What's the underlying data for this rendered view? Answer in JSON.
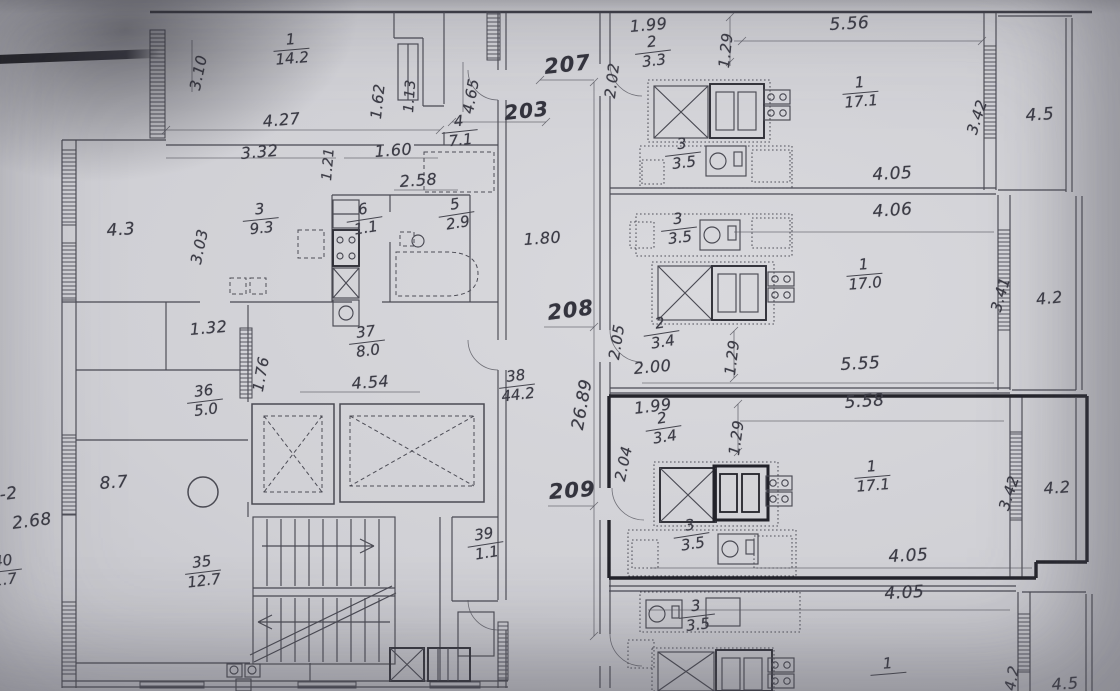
{
  "meta": {
    "document_type": "apartment floor plan photo",
    "selected_unit": "209",
    "colors": {
      "paper": "#cfcfd4",
      "ink": "#4a4a53",
      "highlight_outline": "#24242b",
      "shadow": "#1c1c21"
    }
  },
  "plan": {
    "corridor_numbers": [
      "207",
      "208",
      "209"
    ],
    "labels": [
      {
        "name": "dim-310",
        "text": "3.10",
        "x": 186,
        "y": 88,
        "rot": -78,
        "size": 15
      },
      {
        "name": "dim-162",
        "text": "1.62",
        "x": 367,
        "y": 118,
        "rot": -84,
        "size": 15
      },
      {
        "name": "dim-113",
        "text": "1.13",
        "x": 401,
        "y": 112,
        "rot": -86,
        "size": 14
      },
      {
        "name": "dim-465",
        "text": "4.65",
        "x": 459,
        "y": 112,
        "rot": -80,
        "size": 15
      },
      {
        "name": "dim-427",
        "text": "4.27",
        "x": 262,
        "y": 112,
        "rot": -5,
        "size": 16
      },
      {
        "name": "dim-332",
        "text": "3.32",
        "x": 240,
        "y": 144,
        "rot": -5,
        "size": 16
      },
      {
        "name": "dim-160",
        "text": "1.60",
        "x": 374,
        "y": 142,
        "rot": -4,
        "size": 16
      },
      {
        "name": "dim-121",
        "text": "1.21",
        "x": 319,
        "y": 180,
        "rot": -85,
        "size": 14
      },
      {
        "name": "dim-258",
        "text": "2.58",
        "x": 399,
        "y": 172,
        "rot": -4,
        "size": 16
      },
      {
        "name": "corridor-207",
        "text": "207",
        "x": 543,
        "y": 55,
        "rot": -6,
        "size": 21,
        "big": true
      },
      {
        "name": "dim-203",
        "text": "203",
        "x": 503,
        "y": 101,
        "rot": -6,
        "size": 20,
        "big": true
      },
      {
        "name": "balcony-43",
        "text": "4.3",
        "x": 106,
        "y": 221,
        "rot": -4,
        "size": 17
      },
      {
        "name": "dim-303",
        "text": "3.03",
        "x": 187,
        "y": 262,
        "rot": -78,
        "size": 15
      },
      {
        "name": "dim-180",
        "text": "1.80",
        "x": 523,
        "y": 230,
        "rot": -4,
        "size": 16
      },
      {
        "name": "dim-132",
        "text": "1.32",
        "x": 189,
        "y": 320,
        "rot": -5,
        "size": 16
      },
      {
        "name": "dim-176",
        "text": "1.76",
        "x": 249,
        "y": 390,
        "rot": -80,
        "size": 15
      },
      {
        "name": "dim-454",
        "text": "4.54",
        "x": 351,
        "y": 374,
        "rot": -4,
        "size": 16
      },
      {
        "name": "corridor-208",
        "text": "208",
        "x": 546,
        "y": 301,
        "rot": -7,
        "size": 21,
        "big": true
      },
      {
        "name": "dim-202",
        "text": "2.02",
        "x": 601,
        "y": 97,
        "rot": -83,
        "size": 15
      },
      {
        "name": "dim-205",
        "text": "2.05",
        "x": 605,
        "y": 358,
        "rot": -81,
        "size": 15
      },
      {
        "name": "dim-2689",
        "text": "26.89",
        "x": 568,
        "y": 428,
        "rot": -80,
        "size": 17
      },
      {
        "name": "dim-204",
        "text": "2.04",
        "x": 611,
        "y": 479,
        "rot": -78,
        "size": 15
      },
      {
        "name": "corridor-209",
        "text": "209",
        "x": 548,
        "y": 480,
        "rot": -4,
        "size": 21,
        "big": true
      },
      {
        "name": "hall-87",
        "text": "8.7",
        "x": 99,
        "y": 474,
        "rot": -4,
        "size": 17
      },
      {
        "name": "dim-268",
        "text": "2.68",
        "x": 11,
        "y": 514,
        "rot": -7,
        "size": 17
      },
      {
        "name": "wall-k2",
        "text": "К-2",
        "x": -14,
        "y": 487,
        "rot": -7,
        "size": 17
      },
      {
        "name": "apt207-dim-199",
        "text": "1.99",
        "x": 629,
        "y": 17,
        "rot": -5,
        "size": 16
      },
      {
        "name": "apt207-dim-129",
        "text": "1.29",
        "x": 715,
        "y": 67,
        "rot": -84,
        "size": 15
      },
      {
        "name": "apt207-dim-556",
        "text": "5.56",
        "x": 829,
        "y": 15,
        "rot": -3,
        "size": 17
      },
      {
        "name": "apt207-dim-342",
        "text": "3.42",
        "x": 963,
        "y": 131,
        "rot": -72,
        "size": 15
      },
      {
        "name": "apt207-balcony-45",
        "text": "4.5",
        "x": 1025,
        "y": 106,
        "rot": -4,
        "size": 17
      },
      {
        "name": "apt207-dim-405",
        "text": "4.05",
        "x": 872,
        "y": 165,
        "rot": -3,
        "size": 17
      },
      {
        "name": "apt208-dim-406",
        "text": "4.06",
        "x": 872,
        "y": 202,
        "rot": -4,
        "size": 17
      },
      {
        "name": "apt208-dim-200",
        "text": "2.00",
        "x": 633,
        "y": 359,
        "rot": -5,
        "size": 16
      },
      {
        "name": "apt208-dim-129",
        "text": "1.29",
        "x": 721,
        "y": 374,
        "rot": -83,
        "size": 15
      },
      {
        "name": "apt208-dim-555",
        "text": "5.55",
        "x": 840,
        "y": 355,
        "rot": -3,
        "size": 17
      },
      {
        "name": "apt208-dim-341",
        "text": "3.41",
        "x": 987,
        "y": 309,
        "rot": -74,
        "size": 15
      },
      {
        "name": "apt208-balcony-42",
        "text": "4.2",
        "x": 1035,
        "y": 290,
        "rot": -6,
        "size": 16
      },
      {
        "name": "apt209-dim-199",
        "text": "1.99",
        "x": 633,
        "y": 399,
        "rot": -7,
        "size": 16
      },
      {
        "name": "apt209-dim-129",
        "text": "1.29",
        "x": 725,
        "y": 454,
        "rot": -82,
        "size": 15
      },
      {
        "name": "apt209-dim-558",
        "text": "5.58",
        "x": 844,
        "y": 393,
        "rot": -4,
        "size": 17
      },
      {
        "name": "apt209-dim-342",
        "text": "3.42",
        "x": 995,
        "y": 507,
        "rot": -72,
        "size": 15
      },
      {
        "name": "apt209-balcony-42",
        "text": "4.2",
        "x": 1043,
        "y": 479,
        "rot": -4,
        "size": 16
      },
      {
        "name": "apt209-dim-405",
        "text": "4.05",
        "x": 888,
        "y": 547,
        "rot": -3,
        "size": 17
      },
      {
        "name": "apt210-dim-405",
        "text": "4.05",
        "x": 884,
        "y": 584,
        "rot": -3,
        "size": 17
      },
      {
        "name": "apt210-dim-42",
        "text": "4.2",
        "x": 1001,
        "y": 689,
        "rot": -80,
        "size": 15
      },
      {
        "name": "apt210-balcony-45",
        "text": "4.5",
        "x": 1051,
        "y": 675,
        "rot": -4,
        "size": 16
      }
    ],
    "room_labels": [
      {
        "name": "room-1",
        "num": "1",
        "den": "14.2",
        "x": 272,
        "y": 34,
        "rot": -5
      },
      {
        "name": "room-4",
        "num": "4",
        "den": "7.1",
        "x": 440,
        "y": 116,
        "rot": -6
      },
      {
        "name": "room-3",
        "num": "3",
        "den": "9.3",
        "x": 241,
        "y": 204,
        "rot": -6
      },
      {
        "name": "room-6",
        "num": "6",
        "den": "1.1",
        "x": 344,
        "y": 205,
        "rot": -9
      },
      {
        "name": "room-5",
        "num": "5",
        "den": "2.9",
        "x": 436,
        "y": 200,
        "rot": -9
      },
      {
        "name": "room-37",
        "num": "37",
        "den": "8.0",
        "x": 347,
        "y": 327,
        "rot": -7
      },
      {
        "name": "room-36",
        "num": "36",
        "den": "5.0",
        "x": 185,
        "y": 386,
        "rot": -7
      },
      {
        "name": "room-38",
        "num": "38",
        "den": "44.2",
        "x": 497,
        "y": 371,
        "rot": -7
      },
      {
        "name": "room-35",
        "num": "35",
        "den": "12.7",
        "x": 183,
        "y": 557,
        "rot": -7
      },
      {
        "name": "room-39",
        "num": "39",
        "den": "1.1",
        "x": 465,
        "y": 530,
        "rot": -9
      },
      {
        "name": "room-40",
        "num": "40",
        "den": "1.7",
        "x": -16,
        "y": 556,
        "rot": -7
      },
      {
        "name": "apt207-room-2",
        "num": "2",
        "den": "3.3",
        "x": 633,
        "y": 37,
        "rot": -7
      },
      {
        "name": "apt207-room-1",
        "num": "1",
        "den": "17.1",
        "x": 841,
        "y": 77,
        "rot": -5
      },
      {
        "name": "apt207-room-3",
        "num": "3",
        "den": "3.5",
        "x": 663,
        "y": 139,
        "rot": -7
      },
      {
        "name": "apt208-room-3",
        "num": "3",
        "den": "3.5",
        "x": 659,
        "y": 214,
        "rot": -7
      },
      {
        "name": "apt208-room-1",
        "num": "1",
        "den": "17.0",
        "x": 845,
        "y": 259,
        "rot": -5
      },
      {
        "name": "apt208-room-2",
        "num": "2",
        "den": "3.4",
        "x": 641,
        "y": 319,
        "rot": -9
      },
      {
        "name": "apt209-room-2",
        "num": "2",
        "den": "3.4",
        "x": 643,
        "y": 414,
        "rot": -9
      },
      {
        "name": "apt209-room-1",
        "num": "1",
        "den": "17.1",
        "x": 853,
        "y": 461,
        "rot": -5
      },
      {
        "name": "apt209-room-3",
        "num": "3",
        "den": "3.5",
        "x": 671,
        "y": 521,
        "rot": -9
      },
      {
        "name": "apt210-room-3",
        "num": "3",
        "den": "3.5",
        "x": 677,
        "y": 601,
        "rot": -7
      },
      {
        "name": "apt210-room-1",
        "num": "1",
        "den": "",
        "x": 869,
        "y": 658,
        "rot": -5
      }
    ]
  }
}
